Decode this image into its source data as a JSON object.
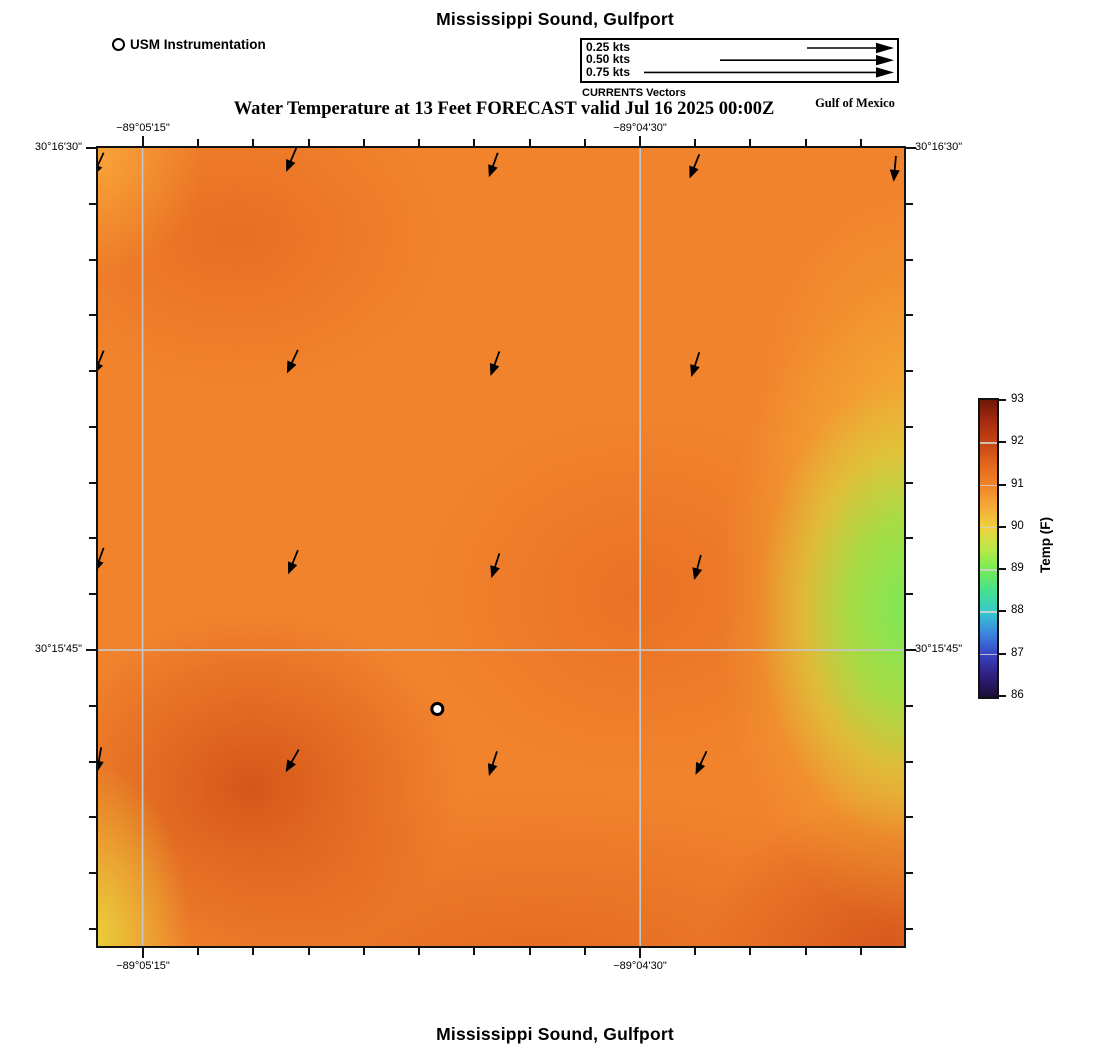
{
  "titles": {
    "top": "Mississippi Sound, Gulfport",
    "subtitle": "Water Temperature at 13 Feet FORECAST valid Jul 16 2025 00:00Z",
    "region": "Gulf of Mexico",
    "bottom": "Mississippi Sound, Gulfport"
  },
  "legend": {
    "instrumentation": "USM Instrumentation",
    "currents_caption": "CURRENTS Vectors",
    "speed_rows": [
      {
        "label": "0.25 kts",
        "tail_x": 225
      },
      {
        "label": "0.50 kts",
        "tail_x": 138
      },
      {
        "label": "0.75 kts",
        "tail_x": 62
      }
    ]
  },
  "axes": {
    "lon_ticks": [
      {
        "label": "−89°05'15\"",
        "x": 143
      },
      {
        "label": "−89°04'30\"",
        "x": 640
      }
    ],
    "lat_ticks": [
      {
        "label": "30°16'30\"",
        "y": 148
      },
      {
        "label": "30°15'45\"",
        "y": 650
      }
    ]
  },
  "colorbar": {
    "title": "Temp (F)",
    "tick_labels": [
      "93",
      "92",
      "91",
      "90",
      "89",
      "88",
      "87",
      "86"
    ],
    "stops": [
      "#6E1607",
      "#A62B10",
      "#C44414",
      "#E2661D",
      "#F08327",
      "#F6A737",
      "#EFD13D",
      "#BCE748",
      "#76EC55",
      "#45E18E",
      "#35C8CE",
      "#3B86E0",
      "#3A43C4",
      "#2E1F7E",
      "#1C0E38"
    ]
  },
  "map": {
    "marker": {
      "name": "USM instrumentation site",
      "x_pct": 42.1,
      "y_pct": 70.3
    },
    "gridline_color": "#C6C6C6",
    "arrow_color": "#000000",
    "arrows": [
      [
        0.7,
        0.6,
        115
      ],
      [
        24.6,
        0.0,
        113
      ],
      [
        49.6,
        0.6,
        110
      ],
      [
        74.6,
        0.8,
        112
      ],
      [
        99.0,
        1.0,
        95
      ],
      [
        0.7,
        25.4,
        112
      ],
      [
        24.8,
        25.3,
        115
      ],
      [
        49.8,
        25.5,
        110
      ],
      [
        74.6,
        25.6,
        108
      ],
      [
        0.7,
        50.1,
        110
      ],
      [
        24.8,
        50.4,
        112
      ],
      [
        49.8,
        50.8,
        108
      ],
      [
        74.8,
        51.0,
        105
      ],
      [
        0.4,
        75.1,
        100
      ],
      [
        24.9,
        75.4,
        120
      ],
      [
        49.5,
        75.6,
        108
      ],
      [
        75.5,
        75.6,
        115
      ]
    ]
  },
  "chart_data": {
    "type": "heatmap",
    "title": "Mississippi Sound, Gulfport",
    "subtitle": "Water Temperature at 13 Feet FORECAST valid Jul 16 2025 00:00Z",
    "region_annotation": "Gulf of Mexico",
    "colorbar_label": "Temp (F)",
    "colorbar_ticks": [
      86,
      87,
      88,
      89,
      90,
      91,
      92,
      93
    ],
    "x_tick_labels": [
      "−89°05'15\"",
      "−89°04'30\""
    ],
    "y_tick_labels": [
      "30°16'30\"",
      "30°15'45\""
    ],
    "legend_entries": [
      "USM Instrumentation",
      "0.25 kts",
      "0.50 kts",
      "0.75 kts",
      "CURRENTS Vectors"
    ],
    "grid_on": true,
    "field_estimate_f": {
      "note": "approximate water temperatures read from colormap; rows north to south, cols west to east",
      "values": [
        [
          91.0,
          91.1,
          91.1,
          91.0,
          91.0
        ],
        [
          91.2,
          91.1,
          91.0,
          91.0,
          90.6
        ],
        [
          91.1,
          91.0,
          91.0,
          91.3,
          89.8
        ],
        [
          91.3,
          91.0,
          91.1,
          91.2,
          89.9
        ],
        [
          90.3,
          91.8,
          91.4,
          91.5,
          90.6
        ]
      ]
    },
    "current_vectors": {
      "count": 17,
      "general_direction": "south-southwest"
    }
  }
}
